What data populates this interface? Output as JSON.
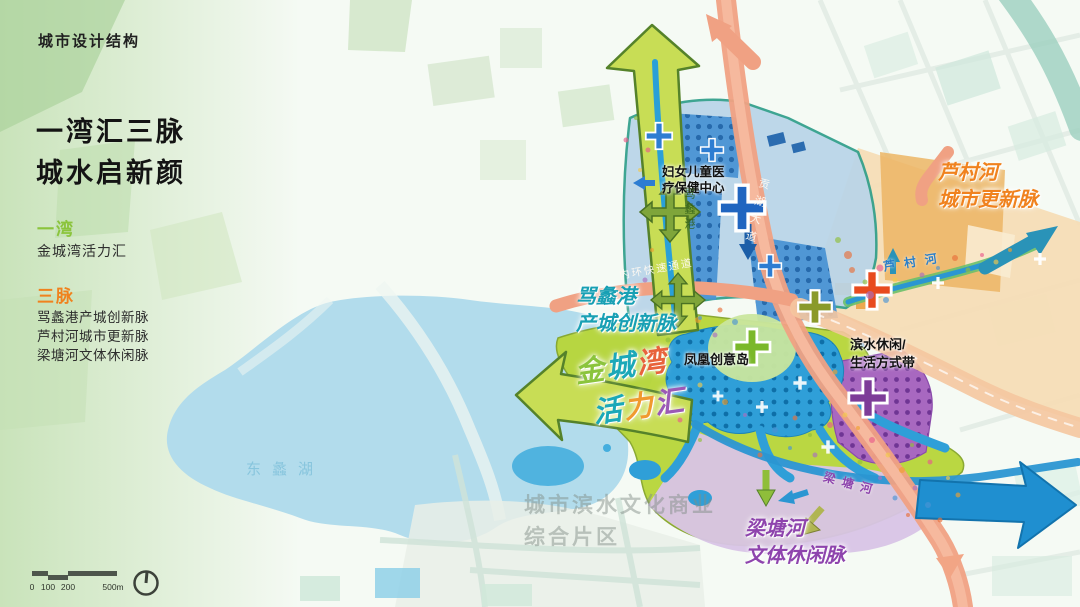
{
  "page": {
    "title_badge": "城市设计结构"
  },
  "sidebar": {
    "headline": "一湾汇三脉\n城水启新颜",
    "legend": {
      "one_bay": {
        "label": "一湾",
        "item": "金城湾活力汇"
      },
      "three_veins": {
        "label": "三脉",
        "items": [
          "骂蠡港产城创新脉",
          "芦村河城市更新脉",
          "梁塘河文体休闲脉"
        ]
      }
    }
  },
  "map": {
    "labels": {
      "hospital": "妇女儿童医\n疗保健中心",
      "lucun_vein": "芦村河\n城市更新脉",
      "mali_vein": "骂蠡港\n产城创新脉",
      "phoenix_island": "凤凰创意岛",
      "waterfront_belt": "滨水休闲/\n生活方式带",
      "liangtang_vein": "梁塘河\n文体休闲脉",
      "district_watermark": "城市滨水文化商业\n综合片区",
      "lake": "东蠡湖",
      "road_inner_ring": "内环快速通道",
      "road_gonghu": "贡湖大道",
      "river_lucun": "芦村河",
      "river_liangtang": "梁塘河",
      "river_mali": "骂蠡港"
    },
    "jincheng_chars": {
      "c1": "金",
      "c2": "城",
      "c3": "湾",
      "c4": "活",
      "c5": "力",
      "c6": "汇"
    },
    "scalebar": {
      "labels": [
        "0",
        "100",
        "200",
        "500m"
      ]
    },
    "colors": {
      "bay_green": "#8bc43c",
      "vein_orange": "#f0821e",
      "vein_teal": "#18a0b4",
      "vein_purple": "#8e44ad",
      "arrow_blue": "#1f8fd0"
    }
  }
}
